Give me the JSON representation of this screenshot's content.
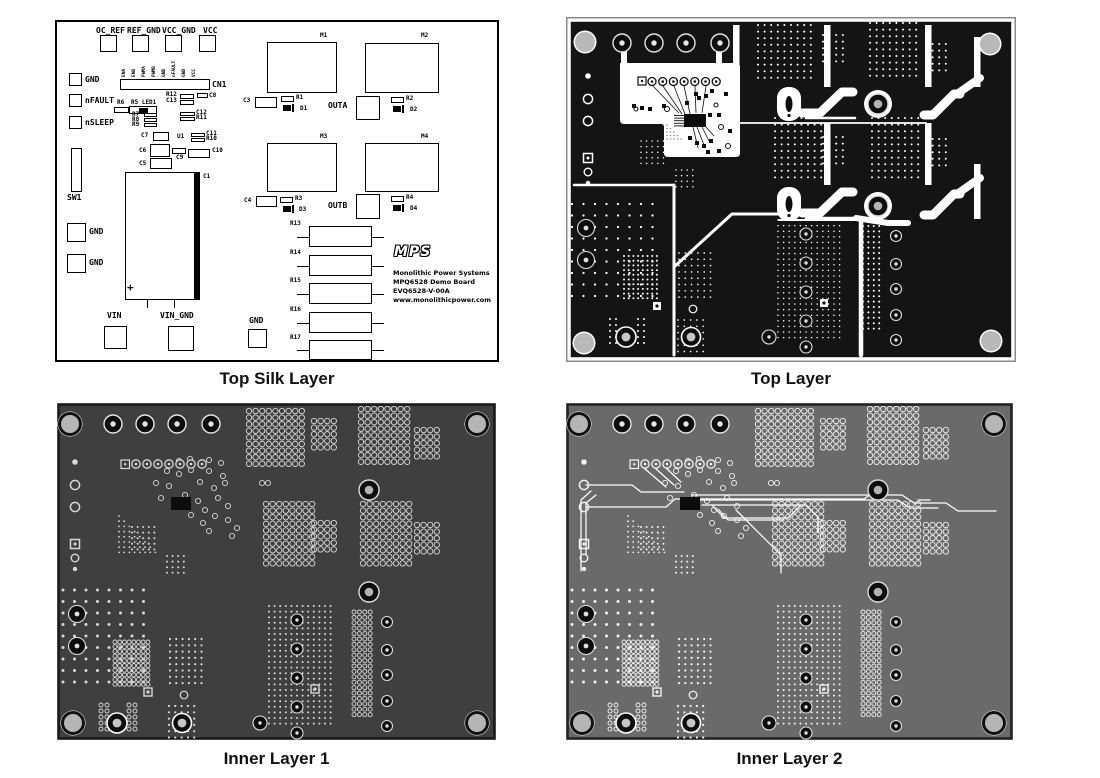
{
  "captions": [
    {
      "id": "silk",
      "label": "Top Silk Layer"
    },
    {
      "id": "top",
      "label": "Top Layer"
    },
    {
      "id": "inner1",
      "label": "Inner Layer 1"
    },
    {
      "id": "inner2",
      "label": "Inner Layer 2"
    }
  ],
  "silk": {
    "cn1_pins": [
      "ENA",
      "ENB",
      "PWMA",
      "PWMB",
      "GND",
      "nFAULT",
      "GND",
      "VCC"
    ],
    "logo": "MPS",
    "info_lines": [
      "Monolithic Power Systems",
      "MPQ6528 Demo Board",
      "EVQ6528-V-00A",
      "www.monolithicpower.com"
    ],
    "items": [
      [
        "T",
        39,
        5,
        "OC_REF"
      ],
      [
        "B",
        43,
        13,
        17,
        17
      ],
      [
        "T",
        70,
        5,
        "REF_GND"
      ],
      [
        "B",
        75,
        13,
        17,
        17
      ],
      [
        "T",
        105,
        5,
        "VCC_GND"
      ],
      [
        "B",
        108,
        13,
        17,
        17
      ],
      [
        "T",
        146,
        5,
        "VCC"
      ],
      [
        "B",
        142,
        13,
        17,
        17
      ],
      [
        "B",
        12,
        51,
        13,
        13
      ],
      [
        "T",
        28,
        54,
        "GND"
      ],
      [
        "B",
        12,
        72,
        13,
        13
      ],
      [
        "T",
        28,
        75,
        "nFAULT"
      ],
      [
        "B",
        12,
        94,
        13,
        13
      ],
      [
        "T",
        28,
        97,
        "nSLEEP"
      ],
      [
        "B",
        14,
        126,
        11,
        44
      ],
      [
        "T",
        10,
        172,
        "SW1"
      ],
      [
        "B",
        63,
        57,
        90,
        11
      ],
      [
        "T",
        155,
        59,
        "CN1"
      ],
      [
        "L",
        60,
        78,
        "R6"
      ],
      [
        "B",
        57,
        85,
        15,
        6
      ],
      [
        "L",
        74,
        78,
        "R5 LED1"
      ],
      [
        "B",
        72,
        84,
        28,
        8
      ],
      [
        "F",
        82,
        86,
        9,
        5
      ],
      [
        "L",
        75,
        90,
        "R7"
      ],
      [
        "B",
        87,
        91,
        13,
        4
      ],
      [
        "L",
        75,
        95,
        "R8"
      ],
      [
        "B",
        87,
        96,
        13,
        4
      ],
      [
        "L",
        75,
        100,
        "R9"
      ],
      [
        "B",
        87,
        101,
        13,
        4
      ],
      [
        "L",
        109,
        70,
        "R12"
      ],
      [
        "B",
        123,
        72,
        14,
        5
      ],
      [
        "L",
        109,
        76,
        "C13"
      ],
      [
        "B",
        123,
        78,
        14,
        5
      ],
      [
        "B",
        140,
        71,
        11,
        5
      ],
      [
        "L",
        152,
        71,
        "C8"
      ],
      [
        "B",
        123,
        90,
        15,
        4
      ],
      [
        "L",
        139,
        88,
        "C12"
      ],
      [
        "B",
        123,
        95,
        15,
        4
      ],
      [
        "L",
        139,
        93,
        "R11"
      ],
      [
        "L",
        84,
        111,
        "C7"
      ],
      [
        "B",
        96,
        110,
        16,
        9
      ],
      [
        "L",
        120,
        112,
        "U1"
      ],
      [
        "B",
        134,
        111,
        14,
        4
      ],
      [
        "L",
        149,
        109,
        "C11"
      ],
      [
        "B",
        134,
        116,
        14,
        4
      ],
      [
        "L",
        149,
        114,
        "R10"
      ],
      [
        "L",
        82,
        126,
        "C6"
      ],
      [
        "B",
        93,
        122,
        20,
        13
      ],
      [
        "B",
        115,
        126,
        14,
        6
      ],
      [
        "L",
        119,
        133,
        "C9"
      ],
      [
        "B",
        131,
        127,
        22,
        9
      ],
      [
        "L",
        155,
        126,
        "C10"
      ],
      [
        "L",
        82,
        139,
        "C5"
      ],
      [
        "B",
        93,
        136,
        22,
        11
      ],
      [
        "B",
        68,
        150,
        75,
        128
      ],
      [
        "F",
        137,
        150,
        6,
        128
      ],
      [
        "L",
        146,
        152,
        "C1"
      ],
      [
        "P",
        70,
        260
      ],
      [
        "V",
        90,
        278,
        8
      ],
      [
        "V",
        117,
        278,
        8
      ],
      [
        "B",
        10,
        201,
        19,
        19
      ],
      [
        "T",
        32,
        206,
        "GND"
      ],
      [
        "B",
        10,
        232,
        19,
        19
      ],
      [
        "T",
        32,
        237,
        "GND"
      ],
      [
        "T",
        50,
        290,
        "VIN"
      ],
      [
        "B",
        47,
        304,
        23,
        23
      ],
      [
        "T",
        103,
        290,
        "VIN_GND"
      ],
      [
        "B",
        111,
        304,
        26,
        25
      ],
      [
        "T",
        192,
        295,
        "GND"
      ],
      [
        "B",
        191,
        307,
        19,
        19
      ],
      [
        "L",
        263,
        11,
        "M1"
      ],
      [
        "B",
        210,
        20,
        70,
        51
      ],
      [
        "L",
        364,
        11,
        "M2"
      ],
      [
        "B",
        308,
        21,
        74,
        50
      ],
      [
        "L",
        186,
        76,
        "C3"
      ],
      [
        "B",
        198,
        75,
        22,
        11
      ],
      [
        "B",
        224,
        74,
        13,
        6
      ],
      [
        "L",
        239,
        73,
        "R1"
      ],
      [
        "D",
        226,
        82,
        13,
        8
      ],
      [
        "L",
        243,
        84,
        "D1"
      ],
      [
        "T",
        271,
        80,
        "OUTA"
      ],
      [
        "B",
        299,
        74,
        24,
        24
      ],
      [
        "B",
        334,
        75,
        13,
        6
      ],
      [
        "L",
        349,
        74,
        "R2"
      ],
      [
        "D",
        336,
        83,
        13,
        8
      ],
      [
        "L",
        353,
        85,
        "D2"
      ],
      [
        "L",
        263,
        112,
        "M3"
      ],
      [
        "B",
        210,
        121,
        70,
        49
      ],
      [
        "L",
        364,
        112,
        "M4"
      ],
      [
        "B",
        308,
        121,
        74,
        49
      ],
      [
        "L",
        187,
        176,
        "C4"
      ],
      [
        "B",
        199,
        174,
        21,
        11
      ],
      [
        "B",
        223,
        175,
        13,
        6
      ],
      [
        "L",
        238,
        174,
        "R3"
      ],
      [
        "D",
        226,
        183,
        13,
        8
      ],
      [
        "L",
        242,
        185,
        "D3"
      ],
      [
        "T",
        271,
        180,
        "OUTB"
      ],
      [
        "B",
        299,
        172,
        24,
        25
      ],
      [
        "B",
        334,
        174,
        13,
        6
      ],
      [
        "L",
        349,
        173,
        "R4"
      ],
      [
        "D",
        336,
        182,
        13,
        8
      ],
      [
        "L",
        353,
        184,
        "D4"
      ],
      [
        "L",
        233,
        199,
        "R13"
      ],
      [
        "R",
        252,
        204,
        63,
        21
      ],
      [
        "L",
        233,
        228,
        "R14"
      ],
      [
        "R",
        252,
        233,
        63,
        21
      ],
      [
        "L",
        233,
        256,
        "R15"
      ],
      [
        "R",
        252,
        261,
        63,
        21
      ],
      [
        "L",
        233,
        285,
        "R16"
      ],
      [
        "R",
        252,
        290,
        63,
        21
      ],
      [
        "L",
        233,
        313,
        "R17"
      ],
      [
        "R",
        252,
        318,
        63,
        20
      ]
    ]
  },
  "layers": {
    "top": {
      "bg": "#141414",
      "art": "#ffffff",
      "hole": "#b8b8b8",
      "border": "#8a8a8a"
    },
    "inner1": {
      "bg": "#3f3f3f",
      "ring": "#d8d8d8",
      "hole": "#b5b5b5",
      "border": "#1a1a1a"
    },
    "inner2": {
      "bg": "#6a6a6a",
      "ring": "#f2f2f2",
      "hole": "#b5b5b5",
      "border": "#222222",
      "trace": "#ffffff"
    }
  }
}
